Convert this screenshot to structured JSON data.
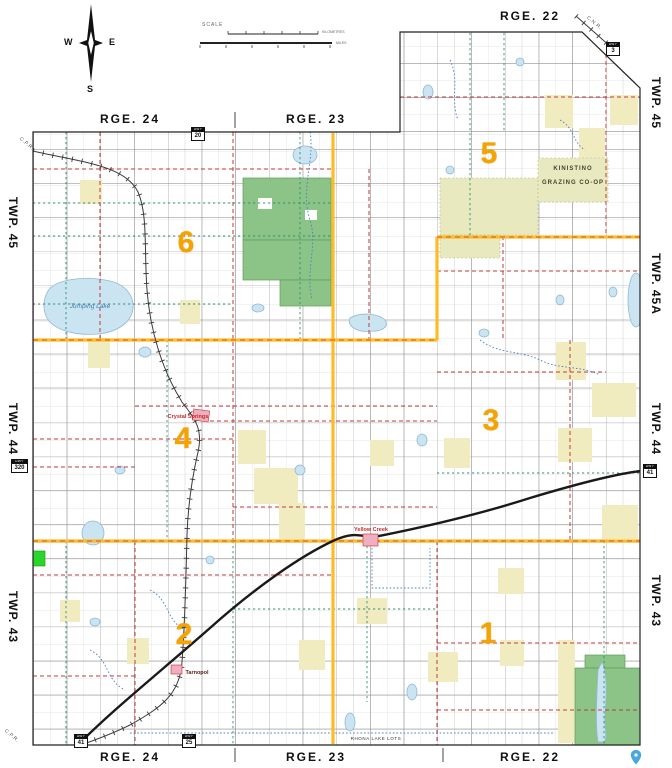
{
  "colors": {
    "yellow_division": "#FFB81C",
    "red_road": "#C23A3A",
    "teal_road": "#2F8F72",
    "blue_road": "#4C7FC4",
    "water_fill": "#CBE4F1",
    "water_edge": "#8FB9D4",
    "green_fill": "#8CC487",
    "green_edge": "#5E9E59",
    "khaki_fill": "#E9E9C0",
    "pale_parcel": "#F1ECC0",
    "bright_green": "#2BD62B",
    "town_pink": "#F0AFC0",
    "town_red": "#C42B2B",
    "rail": "#3A3A3A",
    "highway": "#1A1A1A",
    "division_number": "#F5A300"
  },
  "compass": {
    "w": "W",
    "e": "E",
    "s": "S"
  },
  "scalebar": {
    "label": "SCALE",
    "km": "KILOMETRES",
    "miles": "MILES"
  },
  "ranges": {
    "top_right": "RGE. 22",
    "top": [
      "RGE. 24",
      "RGE. 23"
    ],
    "bottom": [
      "RGE. 24",
      "RGE. 23",
      "RGE. 22"
    ]
  },
  "townships": {
    "left": [
      "TWP. 45",
      "TWP. 44",
      "TWP. 43"
    ],
    "right": [
      "TWP. 45",
      "TWP. 45A",
      "TWP. 44",
      "TWP. 43"
    ]
  },
  "divisions": [
    "5",
    "6",
    "4",
    "3",
    "2",
    "1"
  ],
  "places": {
    "crystal_springs": "Crystal Springs",
    "yellow_creek": "Yellow Creek",
    "tarnopol": "Tarnopol"
  },
  "water": {
    "jumping_lake": "Jumping Lake"
  },
  "land": {
    "coop_line1": "KINISTINO",
    "coop_line2": "GRAZING CO-OP",
    "rhona": "RHONA LAKE LOTS"
  },
  "railways": {
    "cpr": "C.P.R.",
    "cnr": "C.N.R."
  },
  "highways": {
    "prefix": "HWY",
    "shields": [
      "20",
      "3",
      "320",
      "41",
      "41",
      "25"
    ]
  }
}
